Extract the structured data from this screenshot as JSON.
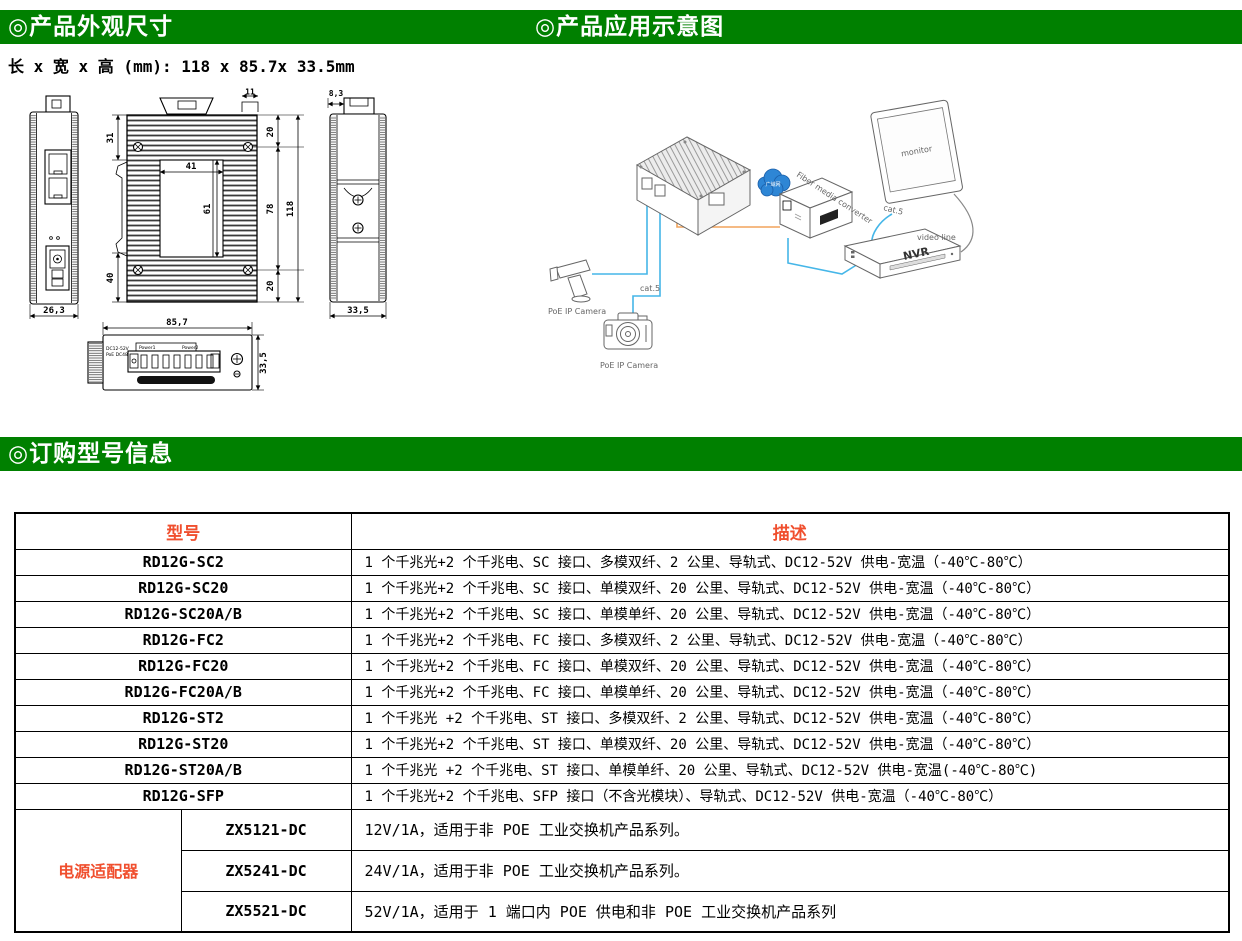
{
  "colors": {
    "header_green": "#008000",
    "accent_red": "#f04f2e",
    "cable_blue": "#45b6e8",
    "cable_orange": "#f2a45c",
    "cloud_blue": "#2e86d5"
  },
  "sections": {
    "dimensions": {
      "title": "◎产品外观尺寸",
      "size_note": "长 x 宽 x 高 (mm): 118 x 85.7x 33.5mm"
    },
    "application": {
      "title": "◎产品应用示意图"
    },
    "ordering": {
      "title": "◎订购型号信息"
    }
  },
  "drawings": {
    "front": {
      "w": "26,3"
    },
    "back": {
      "c11": "11",
      "t20": "20",
      "l31": "31",
      "p41": "41",
      "p61": "61",
      "l40": "40",
      "r78": "78",
      "r118": "118",
      "b20": "20"
    },
    "side": {
      "t83": "8,3",
      "w335": "33,5"
    },
    "bottom": {
      "w857": "85,7",
      "h335": "33,5",
      "line1": "DC12-52V",
      "line2": "PoE DC48-57V",
      "power1": "Power1",
      "power2": "Power2"
    }
  },
  "diagram": {
    "cloud": "广域网",
    "converter": "Fiber media converter",
    "monitor": "monitor",
    "nvr": "NVR",
    "video_line": "video line",
    "cat5_a": "cat.5",
    "cat5_b": "cat.5",
    "camera_a": "PoE IP Camera",
    "camera_b": "PoE IP Camera"
  },
  "table": {
    "headers": {
      "model": "型号",
      "description": "描述"
    },
    "rows": [
      {
        "model": "RD12G-SC2",
        "description": "1 个千兆光+2 个千兆电、SC 接口、多模双纤、2 公里、导轨式、DC12-52V 供电-宽温（-40℃-80℃）"
      },
      {
        "model": "RD12G-SC20",
        "description": "1 个千兆光+2 个千兆电、SC 接口、单模双纤、20 公里、导轨式、DC12-52V 供电-宽温（-40℃-80℃）"
      },
      {
        "model": "RD12G-SC20A/B",
        "description": "1 个千兆光+2 个千兆电、SC 接口、单模单纤、20 公里、导轨式、DC12-52V 供电-宽温（-40℃-80℃）"
      },
      {
        "model": "RD12G-FC2",
        "description": "1 个千兆光+2 个千兆电、FC 接口、多模双纤、2 公里、导轨式、DC12-52V 供电-宽温（-40℃-80℃）"
      },
      {
        "model": "RD12G-FC20",
        "description": "1 个千兆光+2 个千兆电、FC 接口、单模双纤、20 公里、导轨式、DC12-52V 供电-宽温（-40℃-80℃）"
      },
      {
        "model": "RD12G-FC20A/B",
        "description": "1 个千兆光+2 个千兆电、FC 接口、单模单纤、20 公里、导轨式、DC12-52V 供电-宽温（-40℃-80℃）"
      },
      {
        "model": "RD12G-ST2",
        "description": "1 个千兆光 +2 个千兆电、ST 接口、多模双纤、2 公里、导轨式、DC12-52V 供电-宽温（-40℃-80℃）"
      },
      {
        "model": "RD12G-ST20",
        "description": "1 个千兆光+2 个千兆电、ST 接口、单模双纤、20 公里、导轨式、DC12-52V 供电-宽温（-40℃-80℃）"
      },
      {
        "model": "RD12G-ST20A/B",
        "description": "1 个千兆光 +2 个千兆电、ST 接口、单模单纤、20 公里、导轨式、DC12-52V 供电-宽温(-40℃-80℃)"
      },
      {
        "model": "RD12G-SFP",
        "description": "1 个千兆光+2 个千兆电、SFP 接口（不含光模块）、导轨式、DC12-52V 供电-宽温（-40℃-80℃）"
      }
    ],
    "adapters": {
      "label": "电源适配器",
      "rows": [
        {
          "model": "ZX5121-DC",
          "description": "12V/1A，适用于非 POE 工业交换机产品系列。"
        },
        {
          "model": "ZX5241-DC",
          "description": "24V/1A，适用于非 POE 工业交换机产品系列。"
        },
        {
          "model": "ZX5521-DC",
          "description": "52V/1A，适用于 1 端口内 POE 供电和非 POE 工业交换机产品系列"
        }
      ]
    }
  }
}
